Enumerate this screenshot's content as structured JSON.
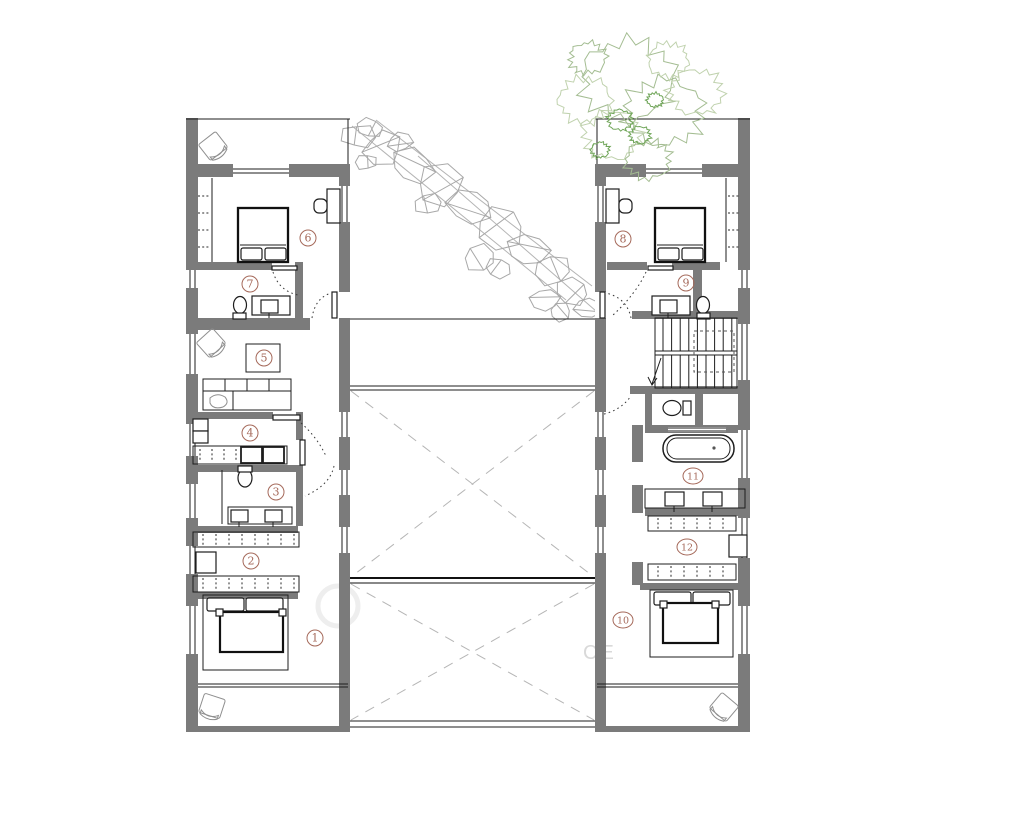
{
  "rooms": [
    {
      "label": "1"
    },
    {
      "label": "2"
    },
    {
      "label": "3"
    },
    {
      "label": "4"
    },
    {
      "label": "5"
    },
    {
      "label": "6"
    },
    {
      "label": "7"
    },
    {
      "label": "8"
    },
    {
      "label": "9"
    },
    {
      "label": "10"
    },
    {
      "label": "11"
    },
    {
      "label": "12"
    }
  ],
  "watermark": {
    "text": "CE"
  },
  "colors": {
    "background": "#ffffff",
    "wall": "#7b7b7b",
    "line": "#1d1d1d",
    "room_label": "#a5695a",
    "void_dash": "#b5b5b5",
    "rock_sketch": "#a8a8a8",
    "tree_green": "#a4bd92",
    "tree_green_bright": "#6fa558",
    "watermark": "#d9d9d9"
  }
}
